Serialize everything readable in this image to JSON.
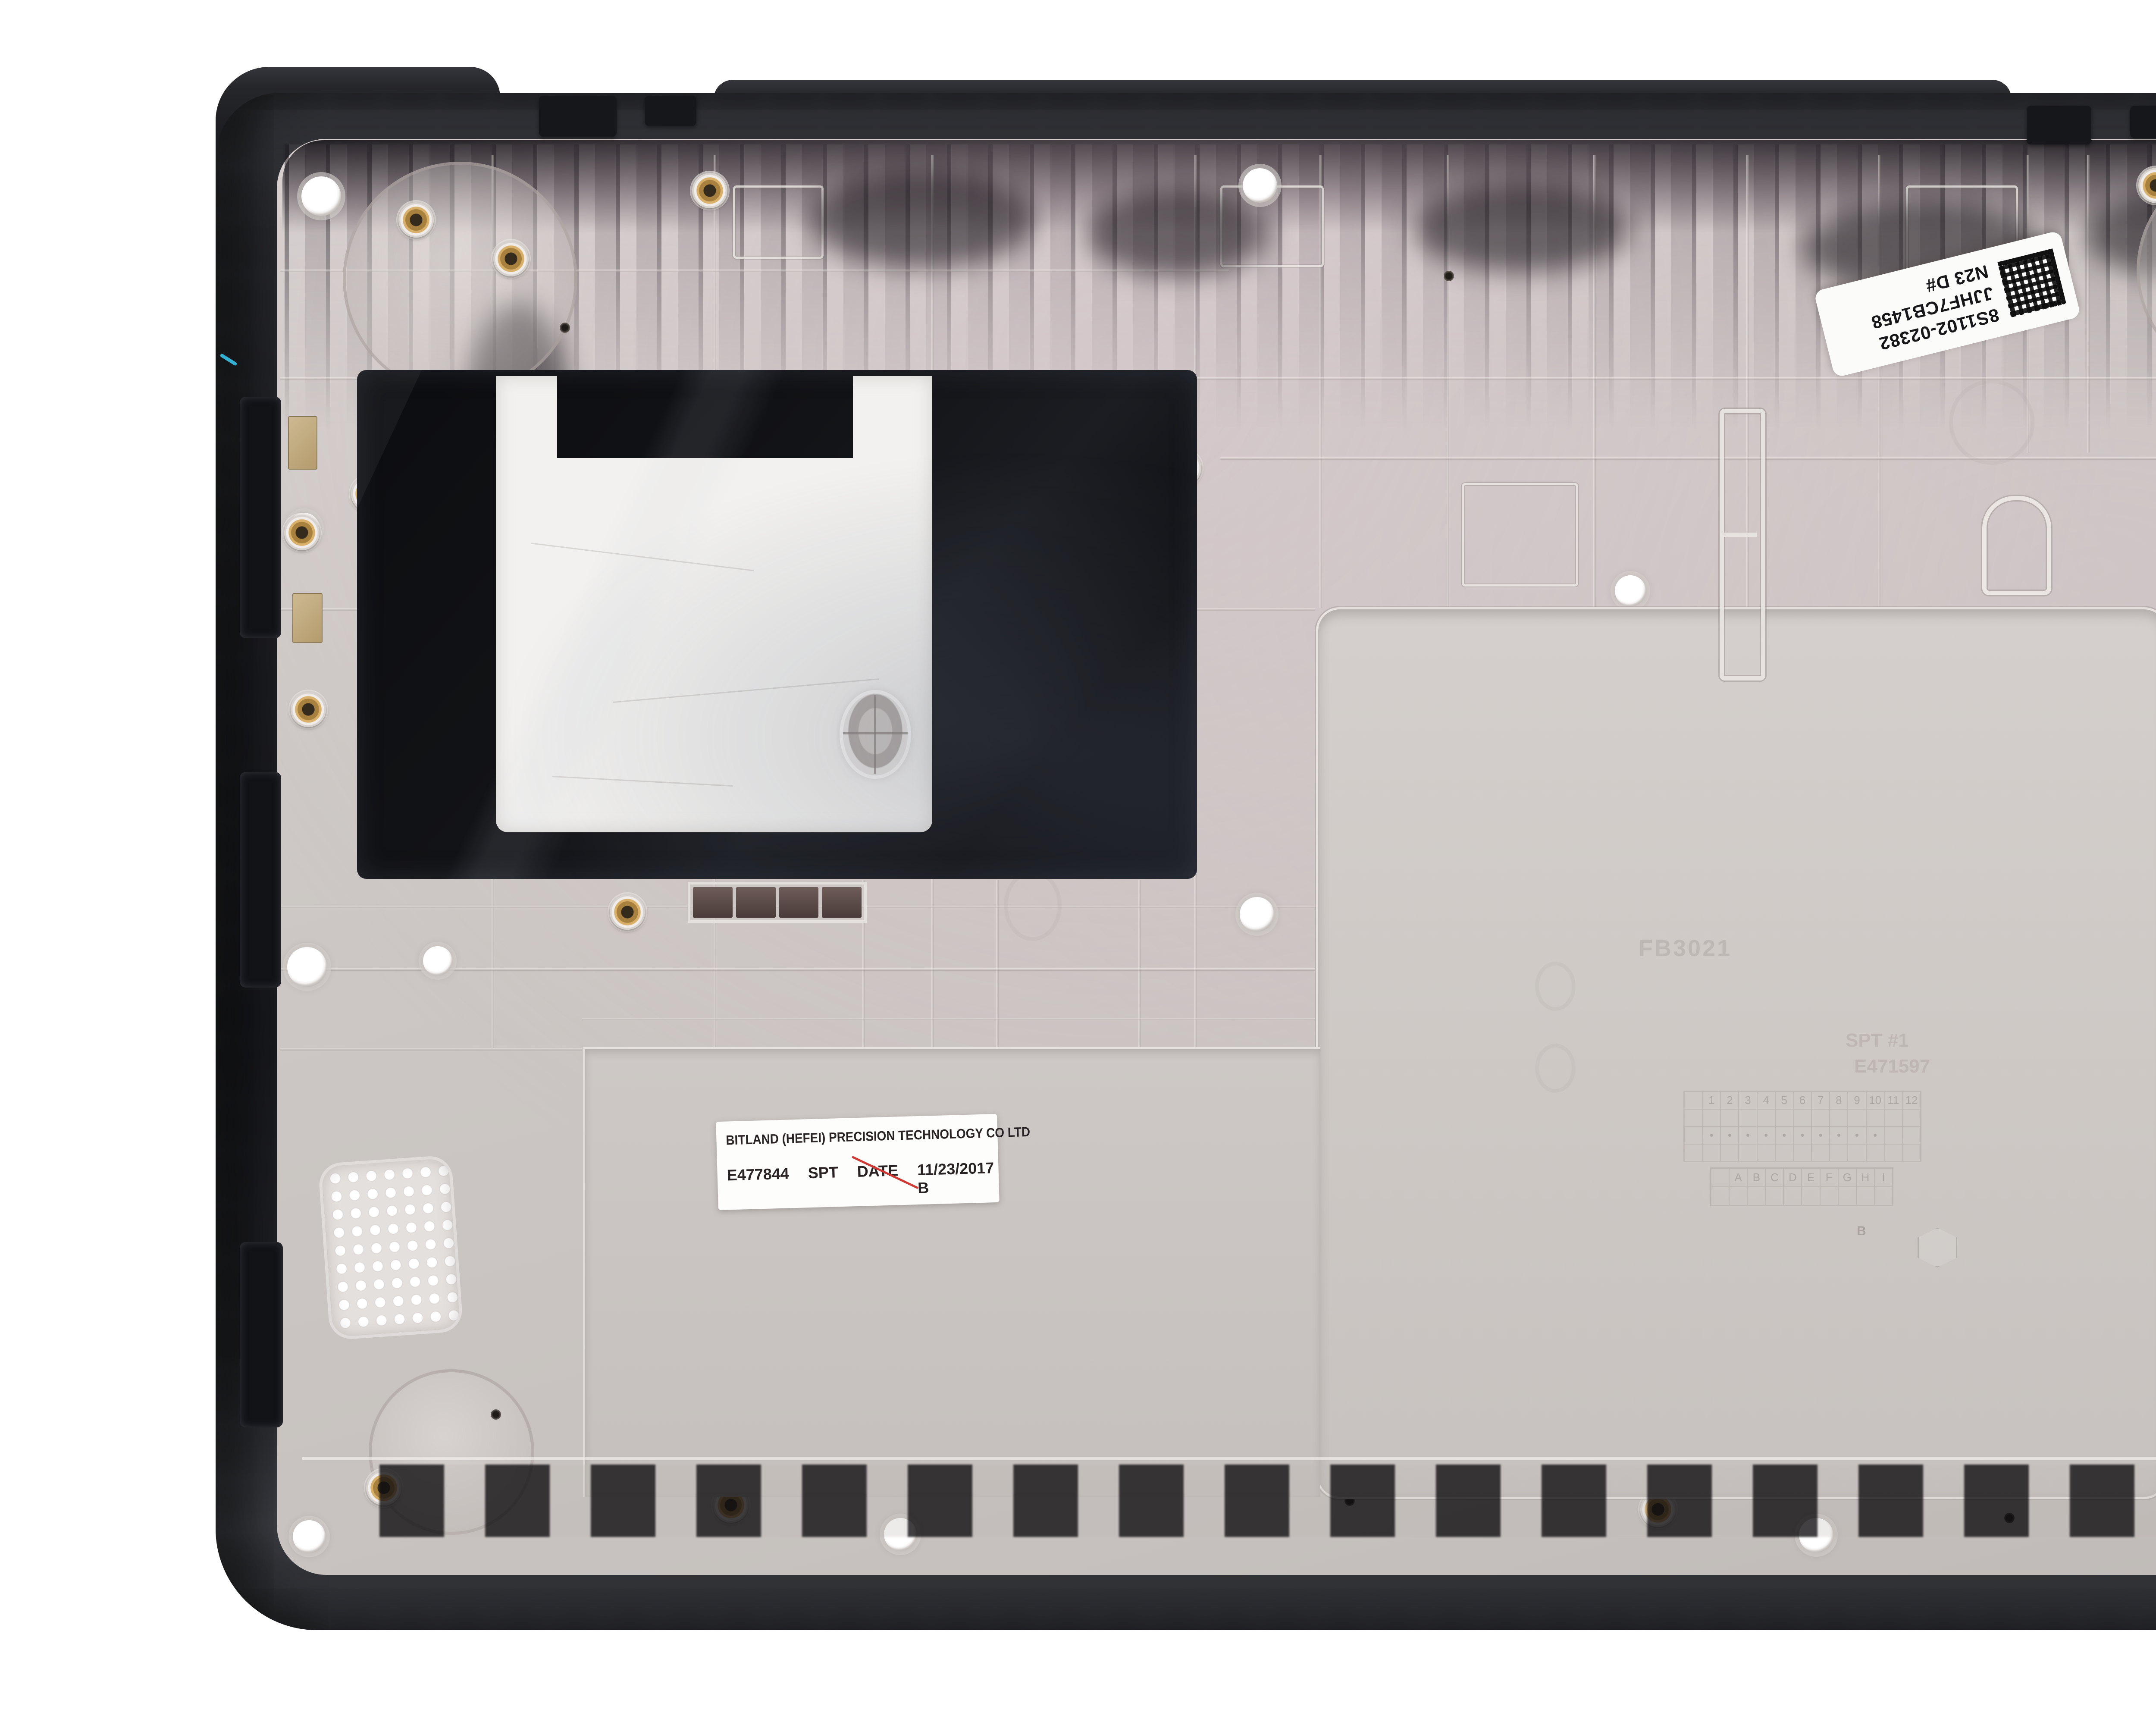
{
  "meta": {
    "description": "Product photograph of a laptop / Chromebook bottom base cover enclosure, interior side facing up, on a white background",
    "object": "Laptop bottom cover (base enclosure), dark outer shell with light grey magnesium-tone interior"
  },
  "part": {
    "barcode_label": {
      "icon": "datamatrix-icon",
      "line1": "8S1102-02382",
      "line2": "JJHF7CB1458",
      "line3": "N23 D#"
    },
    "manufacturer_label": {
      "line1": "BITLAND (HEFEI) PRECISION TECHNOLOGY CO LTD",
      "part_number": "E477844",
      "station": "SPT",
      "date_key": "DATE",
      "date_value": "11/23/2017 B"
    },
    "embossed_marks": {
      "mold_text_1": "FB3021",
      "mold_text_2": "SPT  #1",
      "mold_text_3": "E471597",
      "grid_numbers": [
        "1",
        "2",
        "3",
        "4",
        "5",
        "6",
        "7",
        "8",
        "9",
        "10",
        "11",
        "12"
      ],
      "grid_letters": [
        "A",
        "B",
        "C",
        "D",
        "E",
        "F",
        "G",
        "H",
        "I"
      ],
      "wheel_letter": "B"
    }
  },
  "watermark": {
    "logo_text": "AGI",
    "caption": "AssetGenie Incorporated",
    "map_icon": "world-map-dots-icon",
    "swoosh_icon": "swoosh-icon",
    "flag_icon": "blue-flag-icon"
  },
  "colors": {
    "background": "#ffffff",
    "shell_dark": "#1c1d21",
    "deck_grey": "#cac5c2",
    "mylar_black": "#0e0f12",
    "foil_white": "#f2f1ef",
    "brass_insert": "#d9b06a",
    "label_white": "#fdfdfc",
    "red_mark": "#cf3b34",
    "watermark_grey": "#6e7073",
    "watermark_blue": "#2e9fd4",
    "map_dot_blue": "#7a9ed8",
    "wire_cyan": "#35c2e8"
  }
}
